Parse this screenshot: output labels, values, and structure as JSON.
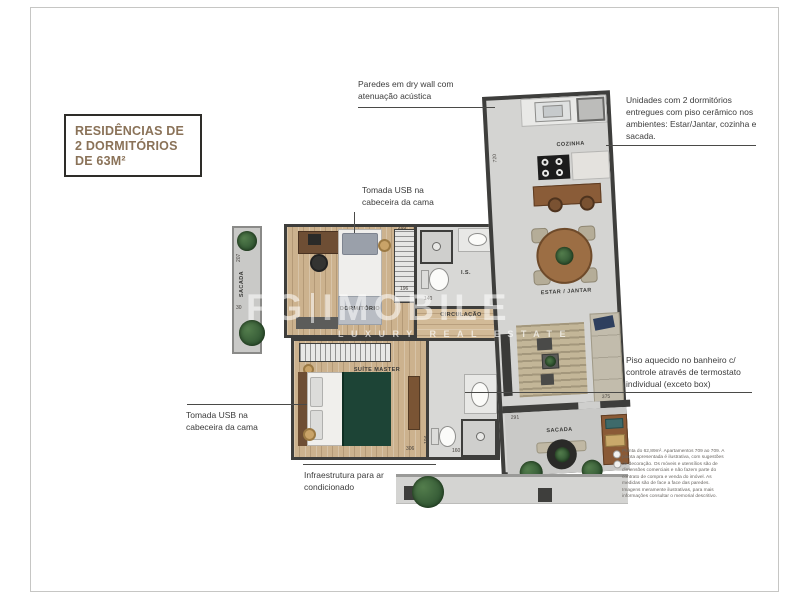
{
  "badge": {
    "line1": "RESIDÊNCIAS DE",
    "line2": "2 DORMITÓRIOS",
    "line3": "DE 63M²"
  },
  "watermark": {
    "brand_left": "FG",
    "brand_right": "IMOBILE",
    "tagline": "LUXURY REAL ESTATE"
  },
  "annotations": {
    "drywall": "Paredes em dry wall com atenuação acústica",
    "units": "Unidades com 2 dormitórios entregues com piso cerâmico nos ambientes: Estar/Jantar, cozinha e sacada.",
    "usb_top": "Tomada USB na cabeceira da cama",
    "usb_left": "Tomada USB na cabeceira da cama",
    "heated_floor": "Piso aquecido no banheiro c/ controle através de termostato individual (exceto box)",
    "ac": "Infraestrutura para ar condicionado",
    "disclaimer": "Planta do 62,89m². Apartamentos 709 ao 709. A planta apresentada é ilustrativa, com sugestões de decoração. Os móveis e utensílios são de dimensões comerciais e não fazem parte do contrato de compra e venda do imóvel. As medidas são de face a face das paredes. Imagens meramente ilustrativas, para mais informações consultar o memorial descritivo."
  },
  "rooms": {
    "cozinha": "COZINHA",
    "estar_jantar": "ESTAR / JANTAR",
    "sacada": "SACADA",
    "sacada_left": "SACADA",
    "dormitorio": "DORMITÓRIO",
    "suite_master": "SUÍTE MASTER",
    "banheiro": "I.S.",
    "circulacao": "CIRCULAÇÃO"
  },
  "dimensions": {
    "d720": "720",
    "d207": "207",
    "d30": "30",
    "d205": "205",
    "d196": "196",
    "d140": "140",
    "d306": "306",
    "d104": "104",
    "d160": "160",
    "d375": "375",
    "d291": "291"
  },
  "colors": {
    "badge_text": "#8a7258",
    "badge_border": "#2e2d29",
    "wall": "#3e3e3c",
    "ceramic_floor": "#d8d8d6",
    "wood_floor": "#ccb28e",
    "balcony_floor": "#c9c9c7",
    "plant_green": "#2f5c36",
    "bed_green": "#1d4436",
    "counter_wood": "#8a5c38",
    "annotation_text": "#3c3c3c"
  }
}
